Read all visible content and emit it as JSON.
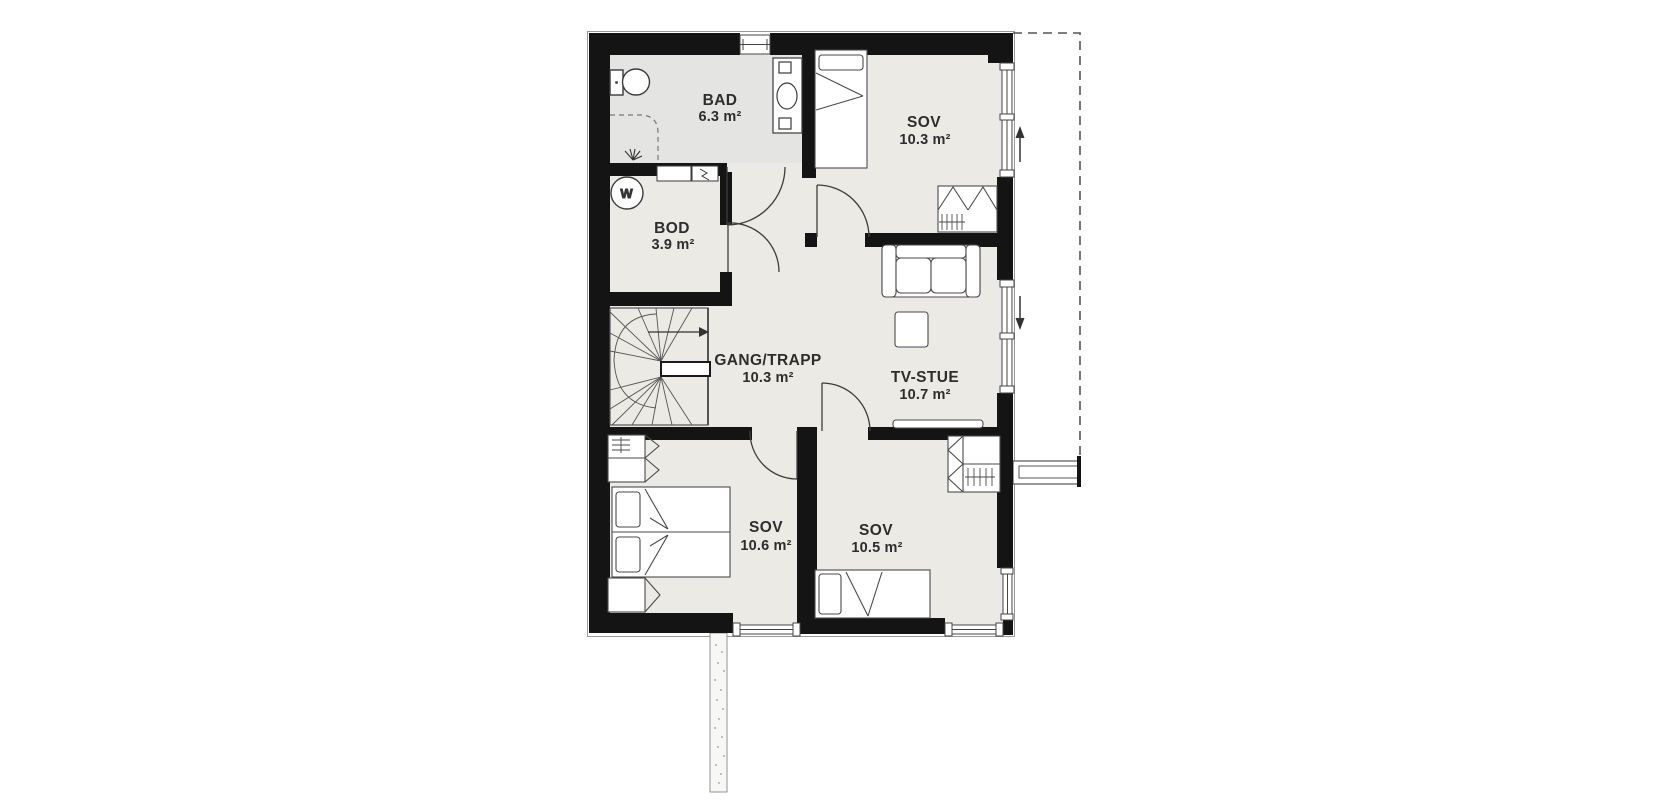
{
  "plan": {
    "rooms": [
      {
        "id": "bad",
        "name": "BAD",
        "area": "6.3 m²"
      },
      {
        "id": "sov1",
        "name": "SOV",
        "area": "10.3 m²"
      },
      {
        "id": "bod",
        "name": "BOD",
        "area": "3.9 m²"
      },
      {
        "id": "gang",
        "name": "GANG/TRAPP",
        "area": "10.3 m²"
      },
      {
        "id": "tvstue",
        "name": "TV-STUE",
        "area": "10.7 m²"
      },
      {
        "id": "sov2",
        "name": "SOV",
        "area": "10.6 m²"
      },
      {
        "id": "sov3",
        "name": "SOV",
        "area": "10.5 m²"
      }
    ],
    "symbols": {
      "washing_machine_label": "W",
      "icons": [
        "toilet-icon",
        "sink-vanity-icon",
        "shower-icon",
        "washing-machine-icon",
        "stairs-icon",
        "bed-icon",
        "double-bed-icon",
        "wardrobe-icon",
        "sofa-icon",
        "ottoman-icon",
        "tv-icon",
        "window-icon",
        "door-swing-icon",
        "balcony-outline",
        "fuse-box-icon",
        "vent-icon",
        "direction-arrow-icon"
      ]
    },
    "colors": {
      "wall": "#141414",
      "floor": "#eceae5",
      "bathroom_floor": "#e4e4e3",
      "line": "#4a4a4a",
      "text": "#2d2d2d",
      "background": "#ffffff"
    }
  }
}
